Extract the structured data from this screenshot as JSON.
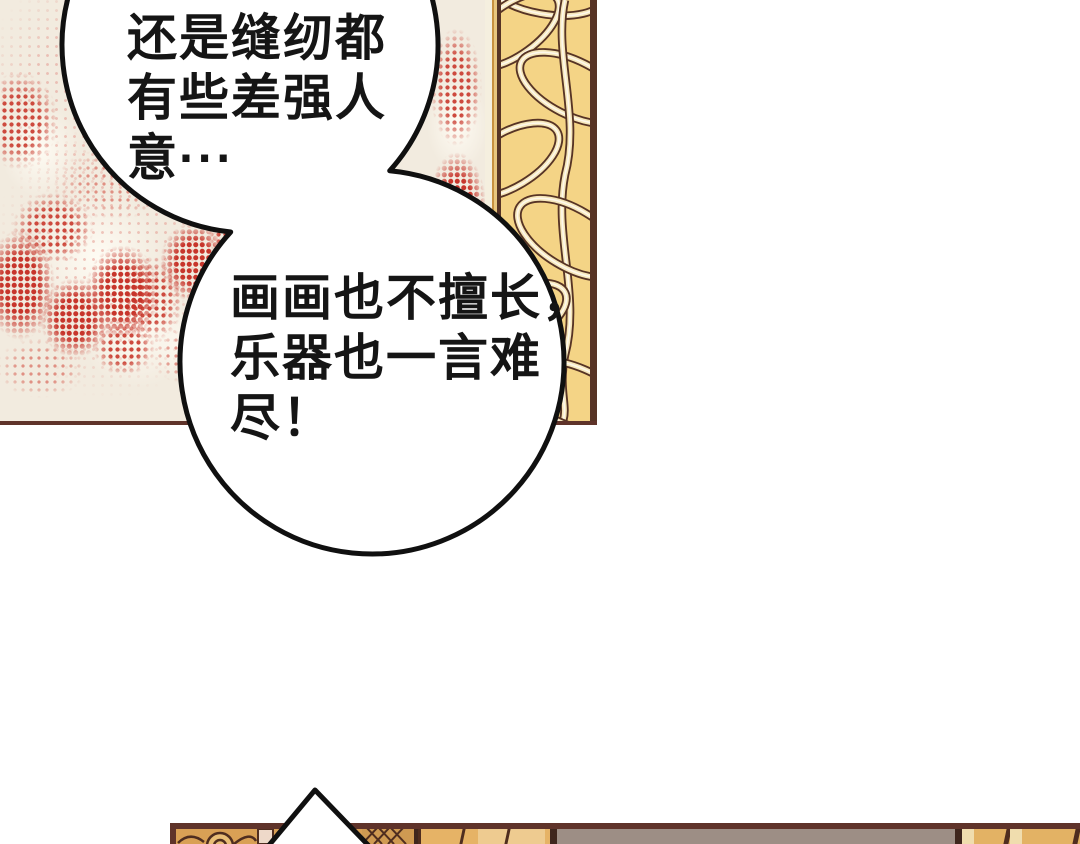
{
  "page_type": "manhua-comic-page",
  "speech_bubbles": [
    {
      "name": "bubble-1",
      "lines": [
        "还是缝纫都",
        "有些差强人",
        "意···"
      ]
    },
    {
      "name": "bubble-2",
      "lines": [
        "画画也不擅长，",
        "乐器也一言难",
        "尽！"
      ]
    }
  ],
  "top_panel": {
    "wall_color": "#f2ebdf",
    "halftone_red": "#c7352b",
    "panel_border_color": "#5f332a",
    "pillar": {
      "gold_base": "#f4d486",
      "ribbon_cream": "#f6e7bb",
      "ribbon_highlight": "#fdf8ec",
      "outline_brown": "#573425"
    }
  },
  "bottom_panel": {
    "border_color": "#5f332a",
    "ornate_gold": "#d9a055",
    "column_gold": "#e6b366",
    "column_highlight": "#f0ddae",
    "taupe_wall": "#9d8e85",
    "dark_line": "#3f261d",
    "pink_strip": "#eed9c9"
  },
  "bubble_style": {
    "fill": "#ffffff",
    "stroke": "#101010"
  }
}
